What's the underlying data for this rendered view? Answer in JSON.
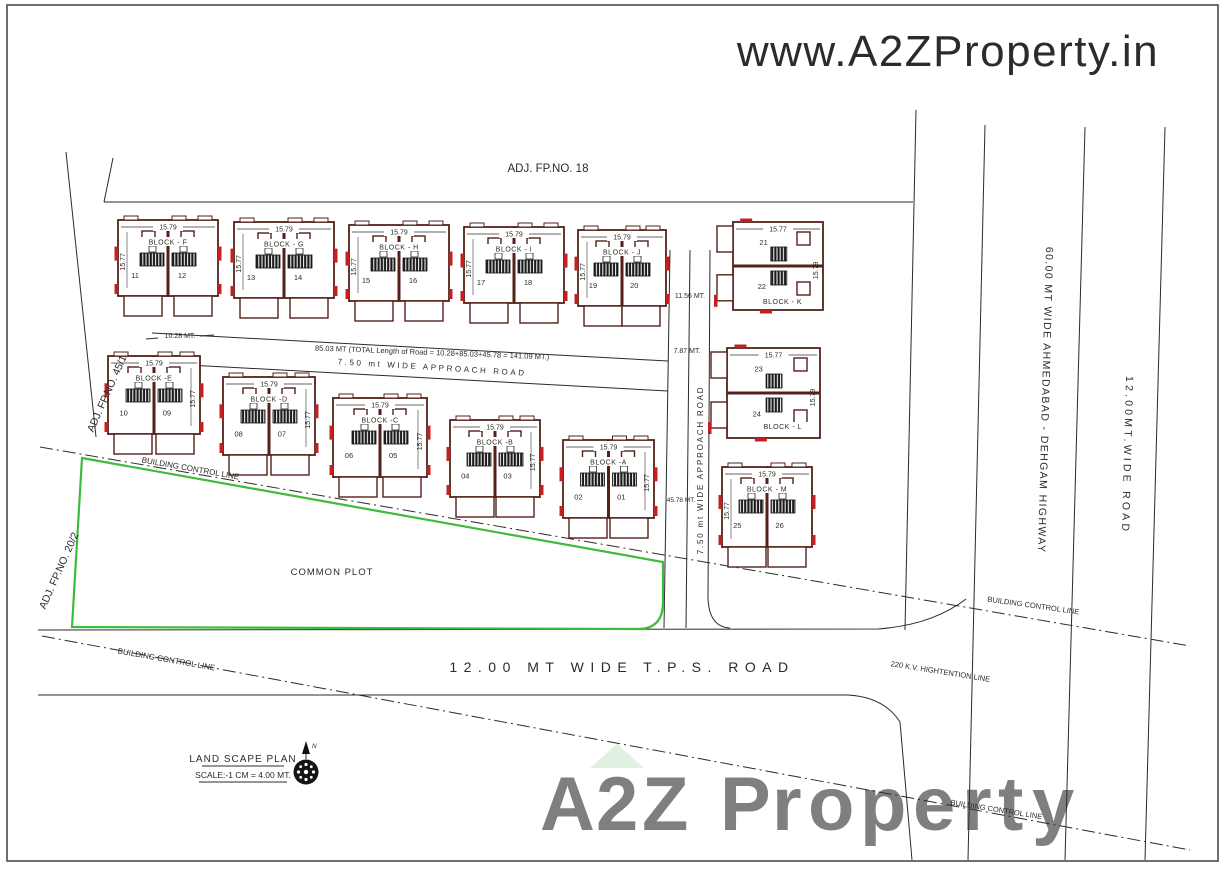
{
  "watermark_top": {
    "text": "www.A2ZProperty.in",
    "color": "#dadada"
  },
  "watermark_bottom": {
    "roof_color": "#c9e3c9",
    "letters": [
      {
        "ch": "A",
        "color": "#f2b2b6",
        "adv": 56
      },
      {
        "ch": "2",
        "color": "#f2b2b6",
        "adv": 46
      },
      {
        "ch": "Z",
        "color": "#f2b2b6",
        "adv": 52
      },
      {
        "ch": " ",
        "color": "#ffffff",
        "adv": 26
      },
      {
        "ch": "P",
        "color": "#b7cde9",
        "adv": 52
      },
      {
        "ch": "r",
        "color": "#f6c3ad",
        "adv": 36
      },
      {
        "ch": "o",
        "color": "#bdd1ec",
        "adv": 52
      },
      {
        "ch": "p",
        "color": "#f7dc9b",
        "adv": 53
      },
      {
        "ch": "e",
        "color": "#c7d5ee",
        "adv": 49
      },
      {
        "ch": "r",
        "color": "#f3b8b8",
        "adv": 36
      },
      {
        "ch": "t",
        "color": "#b9dabd",
        "adv": 34
      },
      {
        "ch": "y",
        "color": "#eae39e",
        "adv": 47
      }
    ]
  },
  "adjacent": {
    "top": "ADJ. FP.NO. 18",
    "left_upper": "ADJ. FP.NO. 45/1",
    "left_lower": "ADJ. FP.NO. 20/2"
  },
  "roads": {
    "total_length": "85.03 MT (TOTAL Length of Road = 10.28+85.03+45.78 = 141.09 MT.)",
    "approach_h": "7.50 mt WIDE APPROACH ROAD",
    "approach_v": "7.50 mt WIDE APPROACH ROAD",
    "tps": "12.00 MT WIDE T.P.S. ROAD",
    "highway": "60.00 MT WIDE AHMEDABAD - DEHGAM HIGHWAY",
    "wide12": "12.00MT.WIDE ROAD",
    "hightension": "220 K.V. HIGHTENTION LINE"
  },
  "dims": {
    "d1028": "10.28 MT.",
    "d1156": "11.56 MT.",
    "d787": "7.87 MT.",
    "d4578": "45.78 MT."
  },
  "labels": {
    "control_line": "BUILDING CONTROL LINE",
    "common_plot": "COMMON PLOT"
  },
  "legend": {
    "title": "LAND SCAPE PLAN",
    "scale": "SCALE:-1 CM = 4.00 MT.",
    "north": "N"
  },
  "colors": {
    "outline": "#55201a",
    "accent": "#c42020",
    "green": "#3dbb3d",
    "line": "#2b2b2b"
  },
  "blocks": [
    {
      "id": "F",
      "type": "h",
      "label": "BLOCK - F",
      "units": [
        "11",
        "12"
      ],
      "dim_top": "15.79",
      "dim_side": "15.77",
      "side": "left",
      "x": 118,
      "y": 220,
      "w": 100,
      "h": 76
    },
    {
      "id": "G",
      "type": "h",
      "label": "BLOCK - G",
      "units": [
        "13",
        "14"
      ],
      "dim_top": "15.79",
      "dim_side": "15.77",
      "side": "left",
      "x": 234,
      "y": 222,
      "w": 100,
      "h": 76
    },
    {
      "id": "H",
      "type": "h",
      "label": "BLOCK - H",
      "units": [
        "15",
        "16"
      ],
      "dim_top": "15.79",
      "dim_side": "15.77",
      "side": "left",
      "x": 349,
      "y": 225,
      "w": 100,
      "h": 76
    },
    {
      "id": "I",
      "type": "h",
      "label": "BLOCK - I",
      "units": [
        "17",
        "18"
      ],
      "dim_top": "15.79",
      "dim_side": "15.77",
      "side": "left",
      "x": 464,
      "y": 227,
      "w": 100,
      "h": 76
    },
    {
      "id": "J",
      "type": "h",
      "label": "BLOCK - J",
      "units": [
        "19",
        "20"
      ],
      "dim_top": "15.79",
      "dim_side": "15.77",
      "side": "left",
      "x": 578,
      "y": 230,
      "w": 88,
      "h": 76
    },
    {
      "id": "K",
      "type": "v",
      "label": "BLOCK - K",
      "units": [
        "21",
        "22"
      ],
      "dim_top": "15.77",
      "dim_side": "15.79",
      "x": 733,
      "y": 222,
      "w": 90,
      "h": 88,
      "label_x": 0.55,
      "label_y": 0.93
    },
    {
      "id": "E",
      "type": "h",
      "label": "BLOCK -E",
      "units": [
        "10",
        "09"
      ],
      "dim_top": "15.79",
      "dim_side": "15.77",
      "side": "right",
      "x": 108,
      "y": 356,
      "w": 92,
      "h": 78
    },
    {
      "id": "D",
      "type": "h",
      "label": "BLOCK -D",
      "units": [
        "08",
        "07"
      ],
      "dim_top": "15.79",
      "dim_side": "15.77",
      "side": "right",
      "x": 223,
      "y": 377,
      "w": 92,
      "h": 78
    },
    {
      "id": "C",
      "type": "h",
      "label": "BLOCK -C",
      "units": [
        "06",
        "05"
      ],
      "dim_top": "15.79",
      "dim_side": "15.77",
      "side": "right",
      "x": 333,
      "y": 398,
      "w": 94,
      "h": 79
    },
    {
      "id": "B",
      "type": "h",
      "label": "BLOCK -B",
      "units": [
        "04",
        "03"
      ],
      "dim_top": "15.79",
      "dim_side": "15.77",
      "side": "right",
      "x": 450,
      "y": 420,
      "w": 90,
      "h": 77
    },
    {
      "id": "A",
      "type": "h",
      "label": "BLOCK -A",
      "units": [
        "02",
        "01"
      ],
      "dim_top": "15.79",
      "dim_side": "15.77",
      "side": "right",
      "x": 563,
      "y": 440,
      "w": 91,
      "h": 78
    },
    {
      "id": "L",
      "type": "v",
      "label": "BLOCK - L",
      "units": [
        "23",
        "24"
      ],
      "dim_top": "15.77",
      "dim_side": "15.79",
      "x": 727,
      "y": 348,
      "w": 93,
      "h": 90,
      "label_x": 0.6,
      "label_y": 0.9
    },
    {
      "id": "M",
      "type": "h",
      "label": "BLOCK - M",
      "units": [
        "25",
        "26"
      ],
      "dim_top": "15.79",
      "dim_side": "15.77",
      "side": "left",
      "x": 722,
      "y": 467,
      "w": 90,
      "h": 80
    }
  ]
}
